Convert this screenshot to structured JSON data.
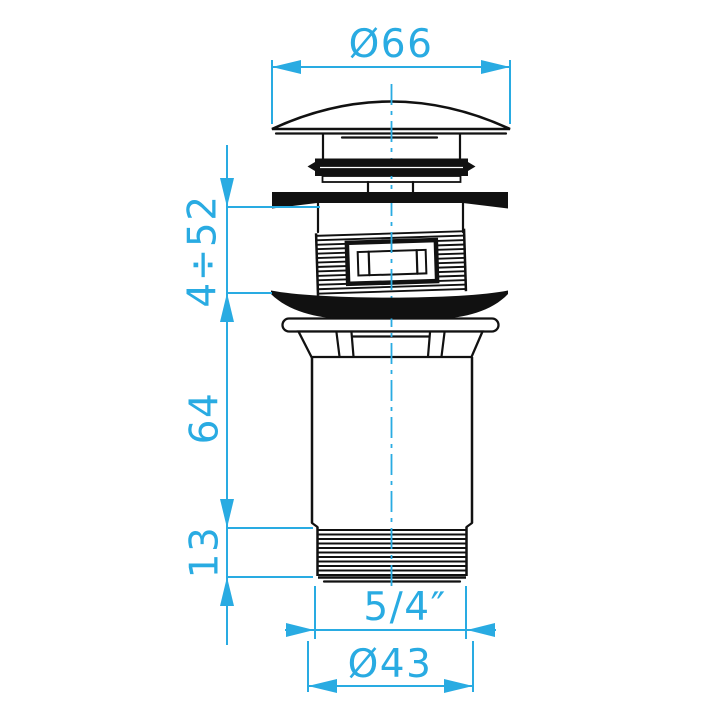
{
  "drawing": {
    "type": "technical-dimension-drawing",
    "background_color": "#ffffff",
    "line_color": "#111111",
    "dimension_color": "#29ABE2",
    "dimensions": {
      "cap_diameter": "Ø66",
      "clamping_range": "4÷52",
      "body_length": "64",
      "thread_length": "13",
      "thread_size": "5/4″",
      "thread_outer_diameter": "Ø43"
    }
  }
}
